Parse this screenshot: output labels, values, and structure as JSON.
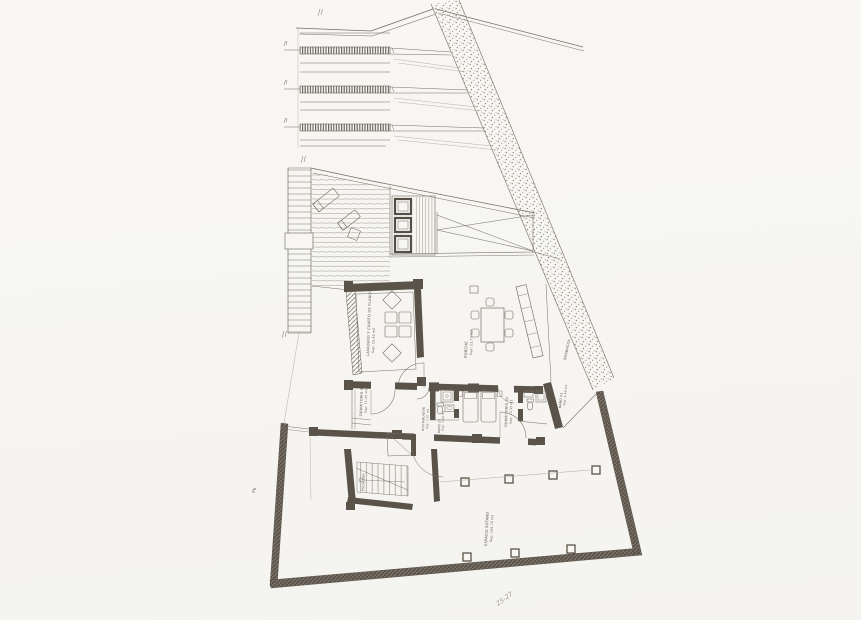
{
  "colors": {
    "paper": "#f7f6f2",
    "ink": "#766e64",
    "faint_ink": "#b0a99e",
    "wall": "#5a5349"
  },
  "annotations": {
    "barbecue": "BARBACOA",
    "plot_marker": "Pb",
    "handwritten_note": "25-27"
  },
  "rooms": {
    "laundry": {
      "name": "LAVADERO Y CUARTO DE PLANCHA",
      "area": "Sup: 10,90 m2"
    },
    "porch": {
      "name": "PORCHE",
      "area": "Sup: 21,77 m2"
    },
    "bedroom_1": {
      "name": "DORMITORIO 01",
      "area": "Sup: 11,15 m2"
    },
    "hall": {
      "name": "DISTRIBUIDOR",
      "area": "Sup: 3,97 m2"
    },
    "bathroom_2": {
      "name": "BAÑO 02",
      "area": "Sup: 3,60 m2"
    },
    "bedroom_2": {
      "name": "DORMITORIO 02",
      "area": "Sup: 13,35 m2"
    },
    "bathroom_3": {
      "name": "BAÑO 03",
      "area": "Sup: 4,40 m2"
    },
    "stair": {
      "name": "ESCALERA"
    },
    "basement": {
      "name": "ESPACIO SOTANO",
      "area": "Sup: 105,76 m2"
    }
  }
}
